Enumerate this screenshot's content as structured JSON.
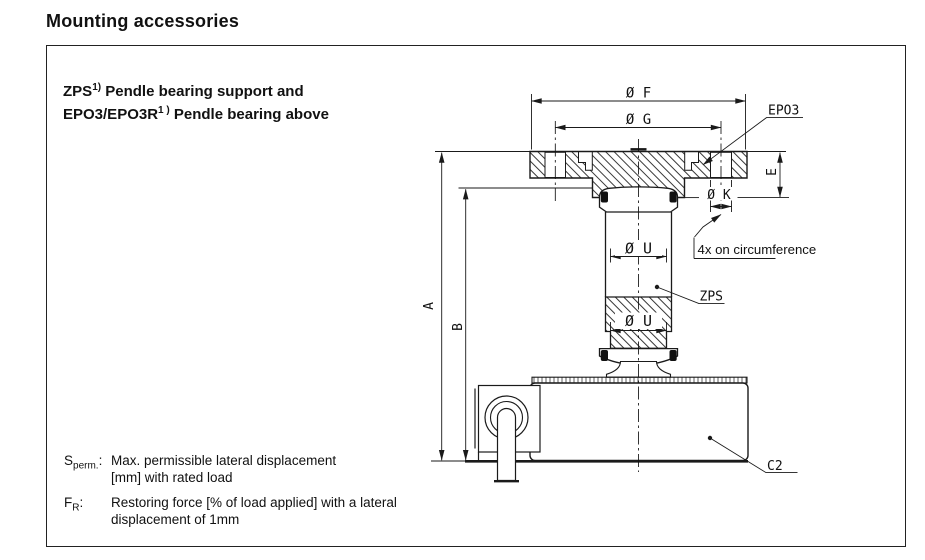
{
  "page": {
    "title": "Mounting accessories"
  },
  "panel": {
    "heading": {
      "l1_main": "ZPS",
      "l1_sup": "1)",
      "l1_rest": " Pendle bearing support and",
      "l2_main": "EPO3/EPO3R",
      "l2_sup": "1 )",
      "l2_rest": " Pendle bearing above"
    },
    "notes": [
      {
        "sym": "S",
        "sub": "perm.",
        "colon": ":",
        "line1": "Max. permissible lateral displacement",
        "line2": "[mm] with rated load"
      },
      {
        "sym": "F",
        "sub": "R",
        "colon": ":",
        "line1": "Restoring force [% of load applied] with a lateral",
        "line2": "displacement of 1mm"
      }
    ]
  },
  "drawing": {
    "dims": {
      "f": "Ø F",
      "g": "Ø G",
      "u": "Ø U",
      "k": "Ø K",
      "a": "A",
      "b": "B",
      "e": "E"
    },
    "labels": {
      "epo3": "EPO3",
      "zps": "ZPS",
      "c2": "C2",
      "note_4x": "4x on circumference"
    },
    "colors": {
      "line": "#1a1a1a"
    }
  }
}
